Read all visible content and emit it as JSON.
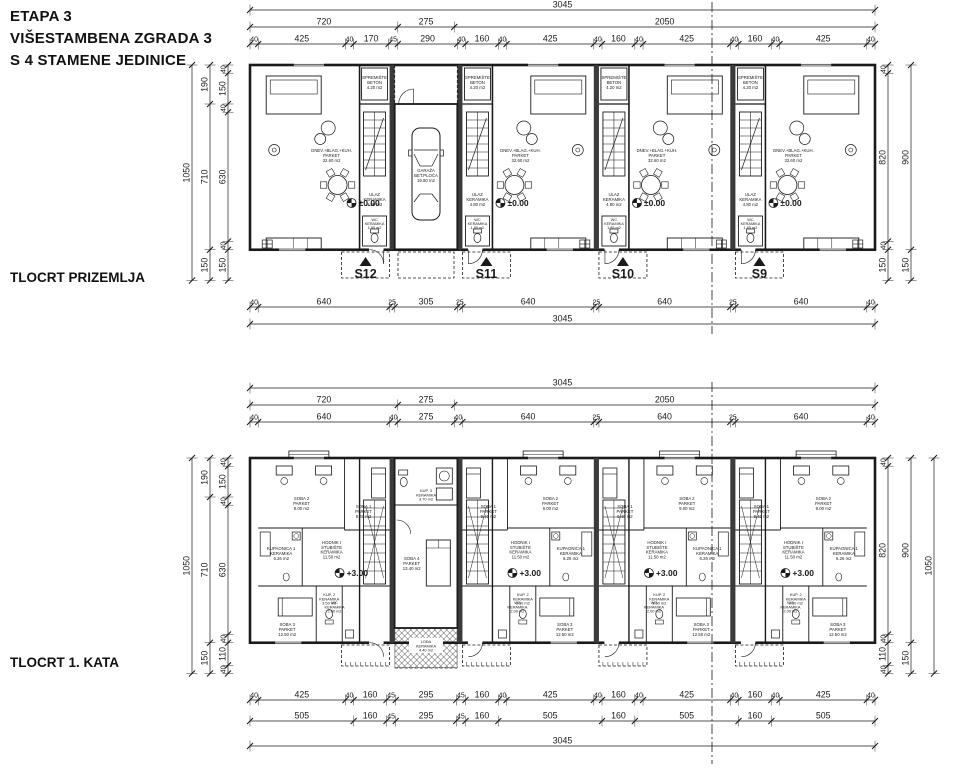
{
  "title": {
    "line1": "ETAPA 3",
    "line2": "VIŠESTAMBENA ZGRADA 3",
    "line3": "S 4 STAMENE JEDINICE"
  },
  "colors": {
    "ink": "#1a1a1a",
    "bg": "#ffffff",
    "wall_fill": "#3a3a3a",
    "hatch": "#777777"
  },
  "ground_floor": {
    "label": "TLOCRT PRIZEMLJA",
    "level_marker": "±0.00",
    "units": [
      "S12",
      "S11",
      "S10",
      "S9"
    ],
    "dims": {
      "top_total": 3045,
      "top_groups": [
        720,
        275,
        2050
      ],
      "top_segments": [
        40,
        425,
        40,
        170,
        45,
        290,
        40,
        160,
        40,
        425,
        40,
        160,
        40,
        425,
        40,
        160,
        40,
        425,
        40
      ],
      "bottom_segments": [
        40,
        640,
        25,
        305,
        25,
        640,
        25,
        640,
        25,
        640,
        40
      ],
      "bottom_total": 3045,
      "left_total": 1050,
      "left_groups": [
        190,
        710,
        150
      ],
      "left_segments": [
        40,
        150,
        40,
        630,
        40,
        150
      ],
      "right_segments": [
        40,
        820,
        40,
        150
      ],
      "right_groups": [
        900,
        150
      ]
    },
    "rooms": {
      "living": [
        "DNEV.+BLAG.+KUH.",
        "PARKET",
        "32.60 m2"
      ],
      "storage": [
        "SPREMIŠTE",
        "BETON",
        "4.20 m2"
      ],
      "entry": [
        "ULAZ",
        "KERAMIKA",
        "4.80 m2"
      ],
      "wc": [
        "WC",
        "KERAMIKA",
        "1.85 m2"
      ],
      "garage": [
        "GARAŽA",
        "BET.PLOČA",
        "19.80 m2"
      ]
    }
  },
  "first_floor": {
    "label": "TLOCRT 1. KATA",
    "level_marker": "+3.00",
    "dims": {
      "top_total": 3045,
      "top_groups": [
        720,
        275,
        2050
      ],
      "top_segments": [
        40,
        640,
        40,
        275,
        40,
        640,
        25,
        640,
        25,
        640,
        40
      ],
      "bottom_segments": [
        40,
        425,
        40,
        160,
        45,
        295,
        45,
        160,
        40,
        425,
        40,
        160,
        40,
        425,
        40,
        160,
        40,
        425,
        40
      ],
      "bottom_groups": [
        505,
        160,
        45,
        295,
        45,
        160,
        505,
        160,
        505,
        160,
        505
      ],
      "bottom_total": 3045,
      "left_total": 1050,
      "left_groups": [
        190,
        710,
        150
      ],
      "left_segments": [
        40,
        150,
        40,
        630,
        40,
        110,
        40
      ],
      "right_segments": [
        40,
        820,
        40,
        110,
        40
      ],
      "right_groups": [
        900,
        150
      ],
      "right_total": 1050
    },
    "rooms": {
      "soba1": [
        "SOBA 1",
        "PARKET",
        "9.40 m2"
      ],
      "soba2": [
        "SOBA 2",
        "PARKET",
        "9.00 m2"
      ],
      "kupaonica": [
        "KUPAONICA 1",
        "KERAMIKA",
        "6.26 m2"
      ],
      "hodnik": [
        "HODNIK I",
        "STUBIŠTE",
        "KERAMIKA",
        "11.50 m2"
      ],
      "soba3": [
        "SOBA 3",
        "PARKET",
        "12.50 m2"
      ],
      "kup2": [
        "KUP. 2",
        "KERAMIKA",
        "3.50 m2"
      ],
      "wc": [
        "WC",
        "KERAMIKA",
        "2.00 m2"
      ],
      "kup3": [
        "KUP. 3",
        "KERAMIKA",
        "3.70 m2"
      ],
      "soba4": [
        "SOBA 4",
        "PARKET",
        "13.40 m2"
      ],
      "loda": [
        "LOĐA",
        "KERAMIKA",
        "4.40 m2"
      ]
    }
  }
}
